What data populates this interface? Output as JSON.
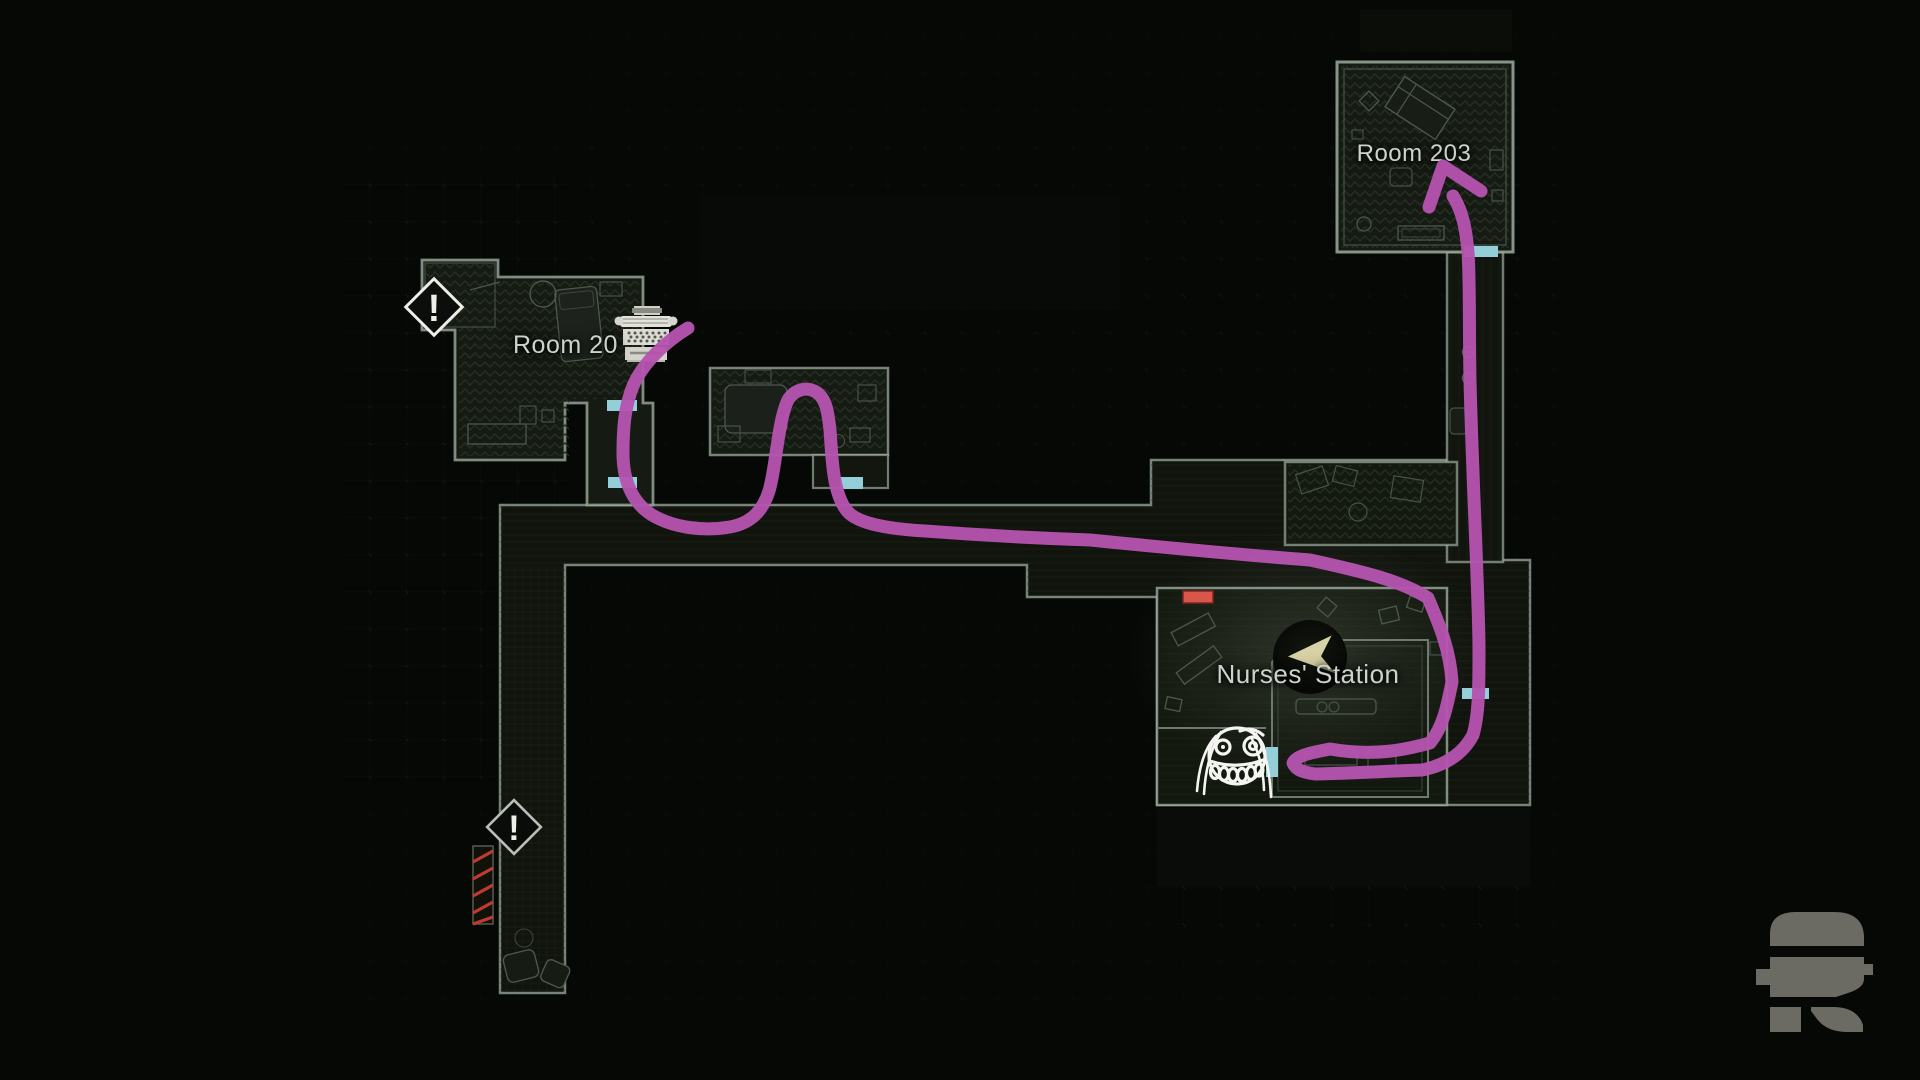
{
  "screen": {
    "kind": "in-game hospital map with hand-drawn route annotation",
    "background_color": "#050805"
  },
  "map": {
    "labels": {
      "room203": "Room 203",
      "room202": "Room 20",
      "nurses_station": "Nurses' Station"
    },
    "alert_glyph": "!",
    "alert_count": 2,
    "door_count": 6,
    "colors": {
      "wall": "#9cab9e",
      "room_fill": "#151a12",
      "corridor_fill": "#10140d",
      "door": "#93ced9",
      "item_marker": "#d8574a",
      "hazard_stripe": "#c13a30",
      "label_text": "#ccd3cb",
      "player_arrow": "#d8d3a6",
      "doodle_ink": "#f4f4f0",
      "logo": "#6b6b64"
    },
    "icons": {
      "typewriter": "typewriter-icon (save point)",
      "player": "player-marker-icon",
      "face": "smiley-face-doodle-icon",
      "alert": "exclamation-icon",
      "watermark": "stylized-R-logo-icon"
    }
  },
  "annotation": {
    "route_color": "#b553af",
    "route_description": "drawn path from Room 202 through corridor, loop into side room, U-turn at Nurses' Station door, arrow up into Room 203"
  }
}
